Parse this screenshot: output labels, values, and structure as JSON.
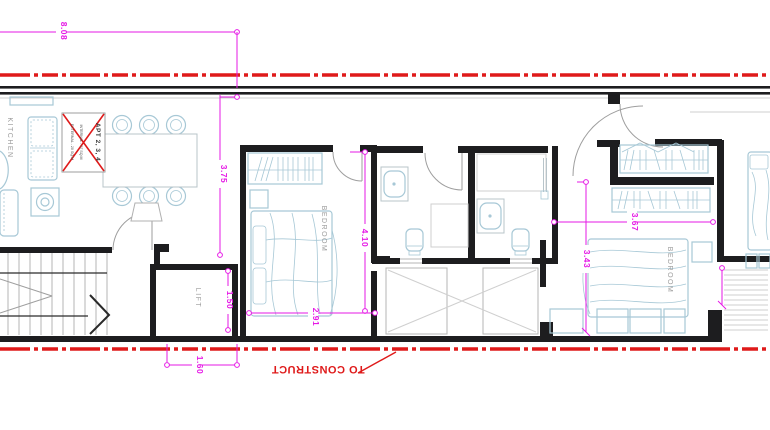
{
  "colors": {
    "dimension": "#e61ae6",
    "construction": "#df1a1a",
    "furniture": "#a7c8d6",
    "wall": "#1d1d1f",
    "room_label": "#9a9a9a"
  },
  "rooms": {
    "kitchen": "KITCHEN",
    "lift": "LIFT",
    "bedroom1": "BEDROOM",
    "bedroom2": "BEDROOM"
  },
  "apt_box": {
    "line1": "APT 2, 3, 4",
    "line2": "INTERNAL - 97 SQ.M",
    "line3": "EXTERNAL - 20 SQ.M"
  },
  "dimensions": {
    "plot_width": "8.08",
    "living_depth": "3.75",
    "bedroom1_depth": "4.10",
    "bedroom1_width": "2.91",
    "lift_depth": "1.50",
    "lift_width": "1.60",
    "bedroom2_width": "3.67",
    "bedroom2_depth": "3.43"
  },
  "notes": {
    "to_construct": "TO CONSTRUCT"
  }
}
